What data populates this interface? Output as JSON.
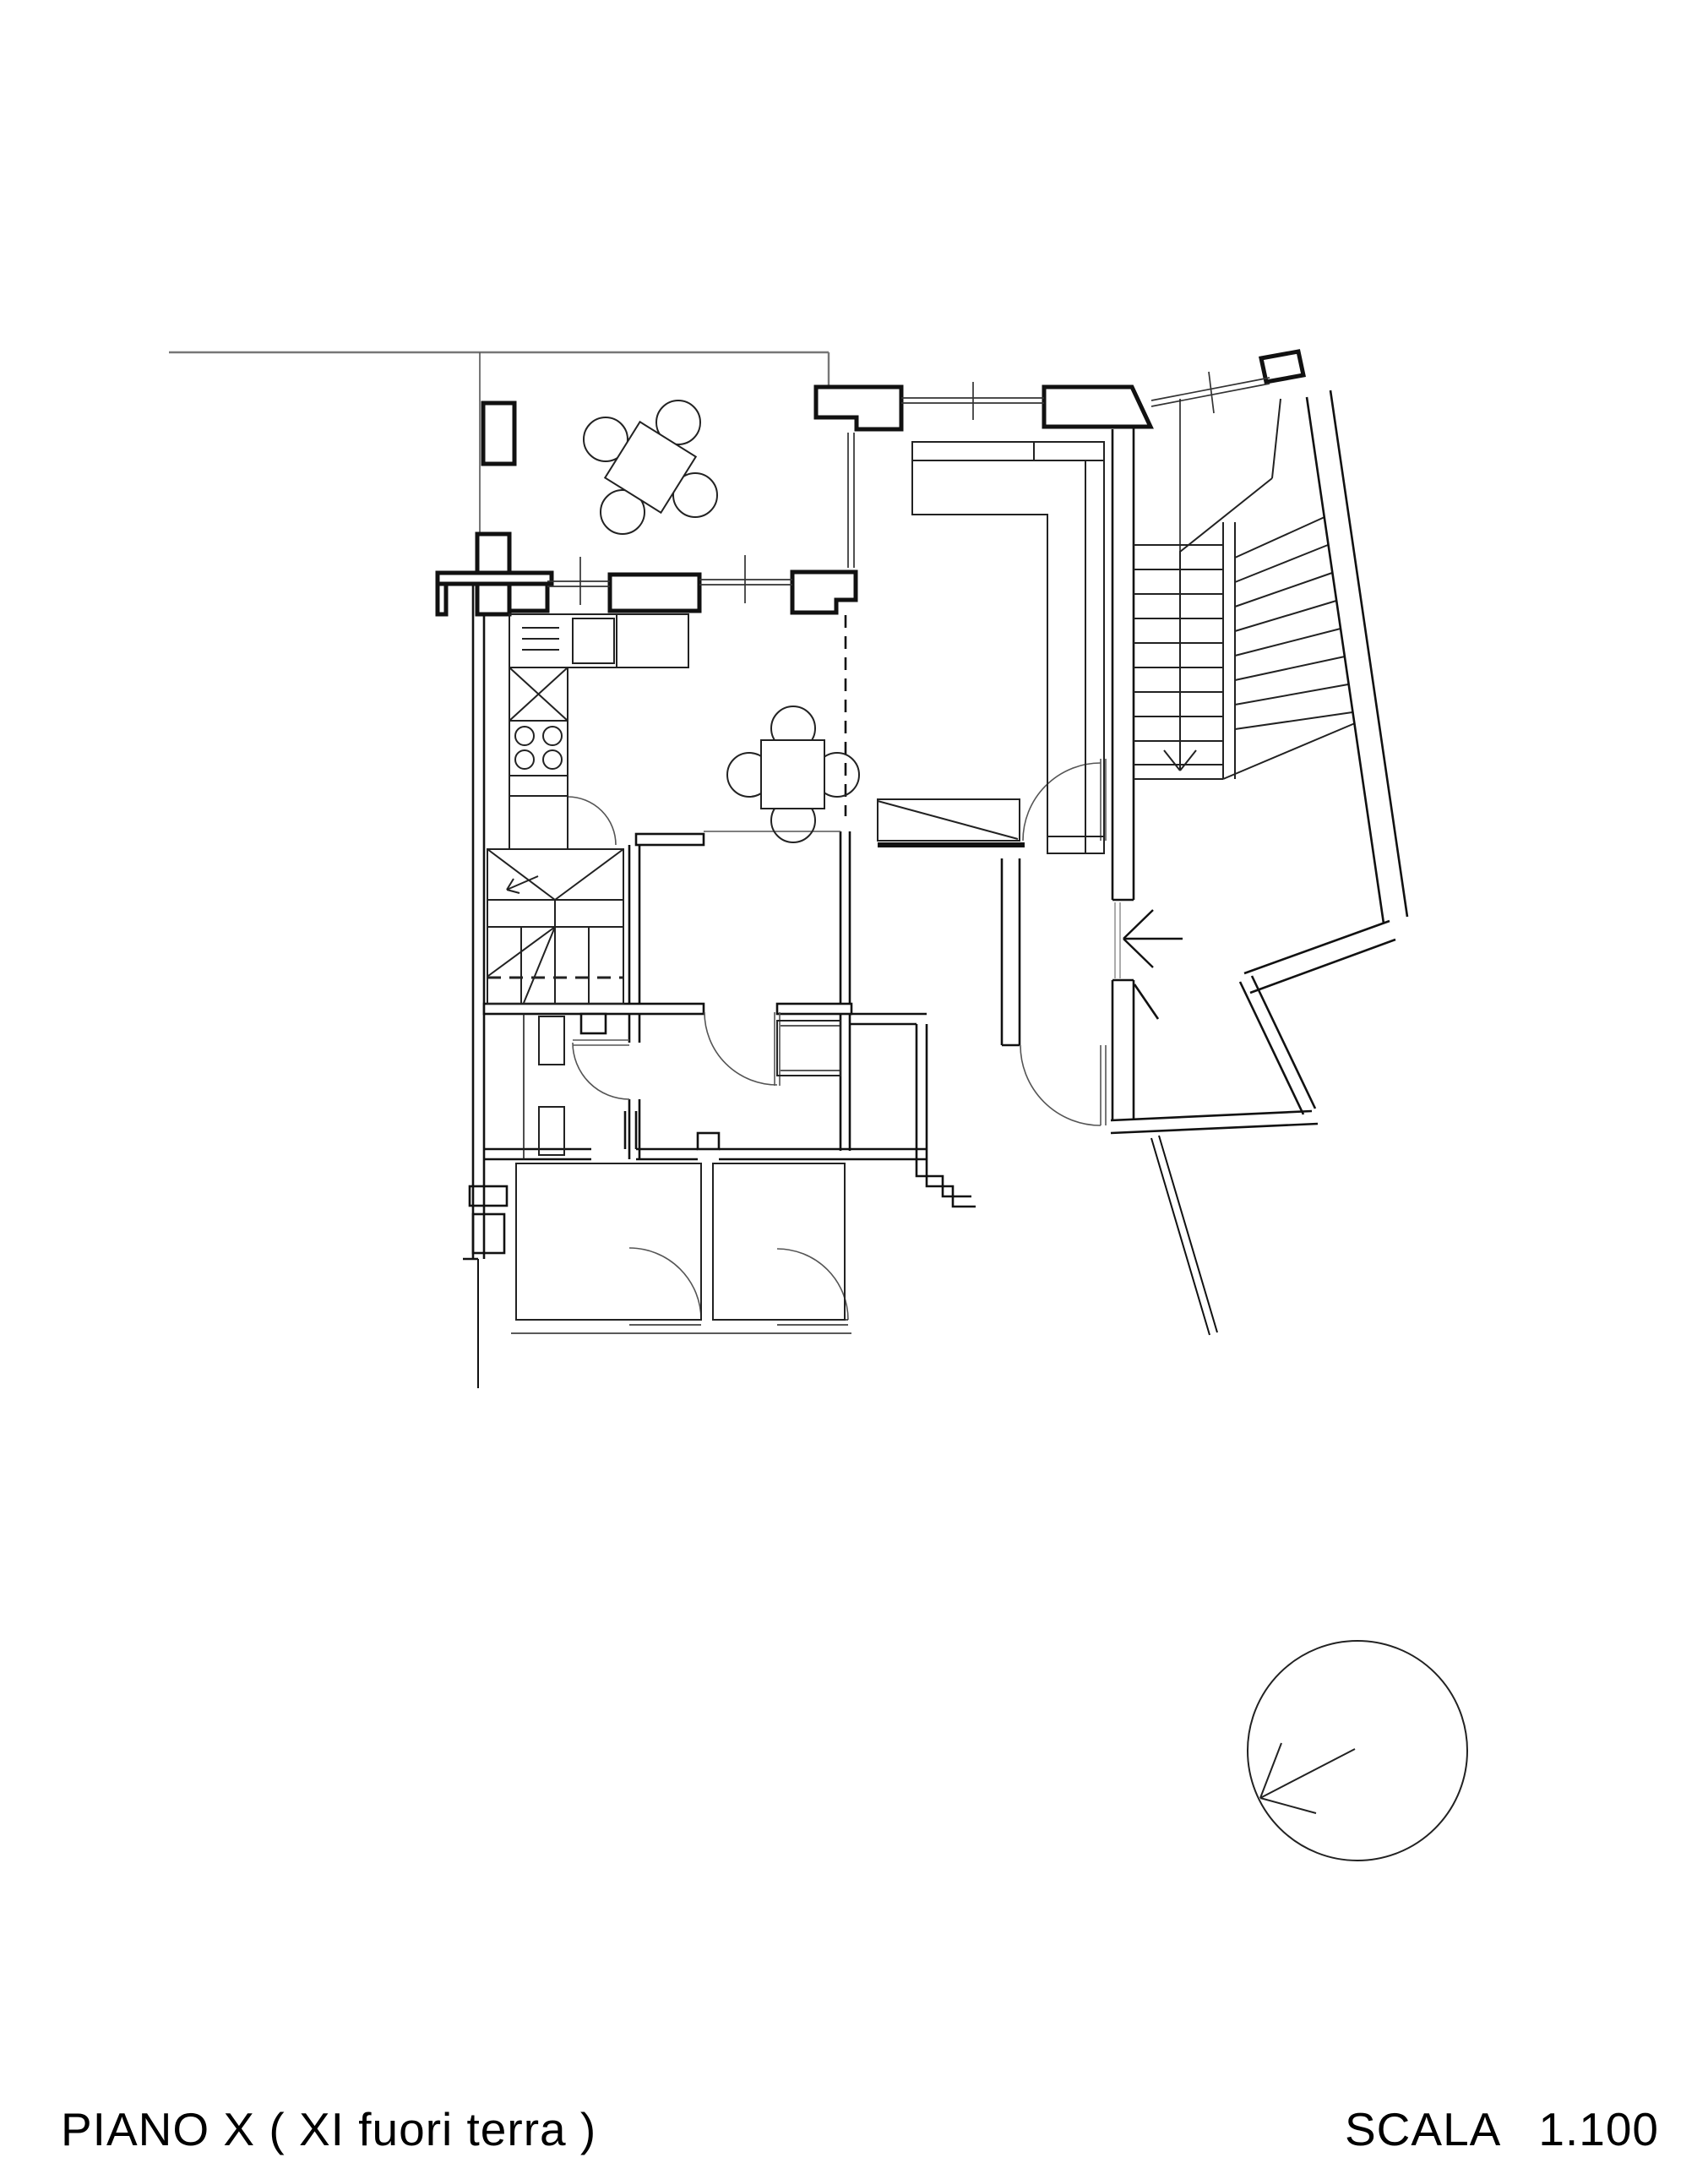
{
  "drawing": {
    "type": "architectural-floor-plan",
    "floor_label": "PIANO X ( XI fuori terra )",
    "scale": {
      "word": "SCALA",
      "value": "1.100"
    },
    "palette": {
      "paper": "#ffffff",
      "wall": "#111111",
      "thin_line": "#333333",
      "light_line": "#777777",
      "text": "#000000"
    },
    "symbols": [
      "terrace-table-icon",
      "terrace-chair-icon",
      "dining-table-icon",
      "dining-chair-icon",
      "sofa-icon",
      "kitchen-sink-icon",
      "stove-burners-icon",
      "fridge-cross-icon",
      "winder-stair-icon",
      "main-stair-icon",
      "door-swing-icon",
      "window-double-line-icon",
      "entry-arrow-icon",
      "down-arrow-icon",
      "tree-icon"
    ]
  }
}
